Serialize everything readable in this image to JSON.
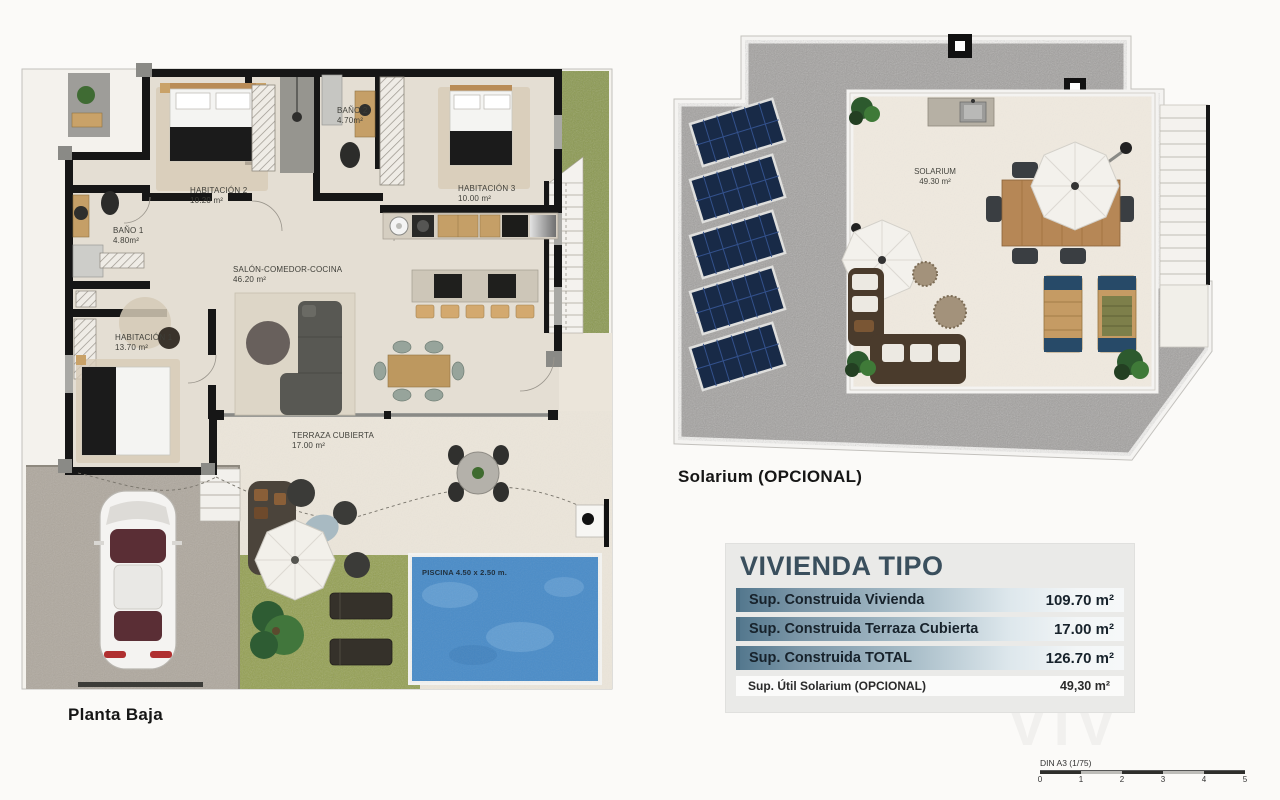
{
  "ground_floor": {
    "caption": "Planta Baja",
    "rooms": {
      "hab2": {
        "name": "HABITACIÓN 2",
        "area": "10.20 m²"
      },
      "bano2": {
        "name": "BAÑO 2",
        "area": "4.70m²"
      },
      "hab3": {
        "name": "HABITACIÓN 3",
        "area": "10.00 m²"
      },
      "bano1": {
        "name": "BAÑO 1",
        "area": "4.80m²"
      },
      "hab1": {
        "name": "HABITACIÓN 1",
        "area": "13.70 m²"
      },
      "salon": {
        "name": "SALÓN-COMEDOR-COCINA",
        "area": "46.20 m²"
      },
      "terraza": {
        "name": "TERRAZA CUBIERTA",
        "area": "17.00 m²"
      }
    },
    "pool_label": "PISCINA 4.50 x 2.50 m."
  },
  "solarium_floor": {
    "caption": "Solarium (OPCIONAL)",
    "room": {
      "name": "SOLARIUM",
      "area": "49.30 m²"
    },
    "solar_panel_count": 5
  },
  "summary": {
    "title": "VIVIENDA TIPO",
    "rows": [
      {
        "label": "Sup. Construida Vivienda",
        "value": "109.70 m²"
      },
      {
        "label": "Sup. Construida Terraza Cubierta",
        "value": "17.00 m²"
      },
      {
        "label": "Sup. Construida TOTAL",
        "value": "126.70 m²"
      }
    ],
    "optional_row": {
      "label": "Sup. Útil Solarium (OPCIONAL)",
      "value": "49,30 m²"
    }
  },
  "scale": {
    "label": "DIN A3 (1/75)",
    "ticks": [
      "0",
      "1",
      "2",
      "3",
      "4",
      "5"
    ]
  },
  "watermark": "VIV",
  "colors": {
    "accent_title": "#3a4f5d",
    "row_gradient_left": "#54788e",
    "pool_blue": "#4a8cc8",
    "grass_green": "#8b9950",
    "solar_panel_navy": "#182a47",
    "wall_black": "#161616"
  }
}
